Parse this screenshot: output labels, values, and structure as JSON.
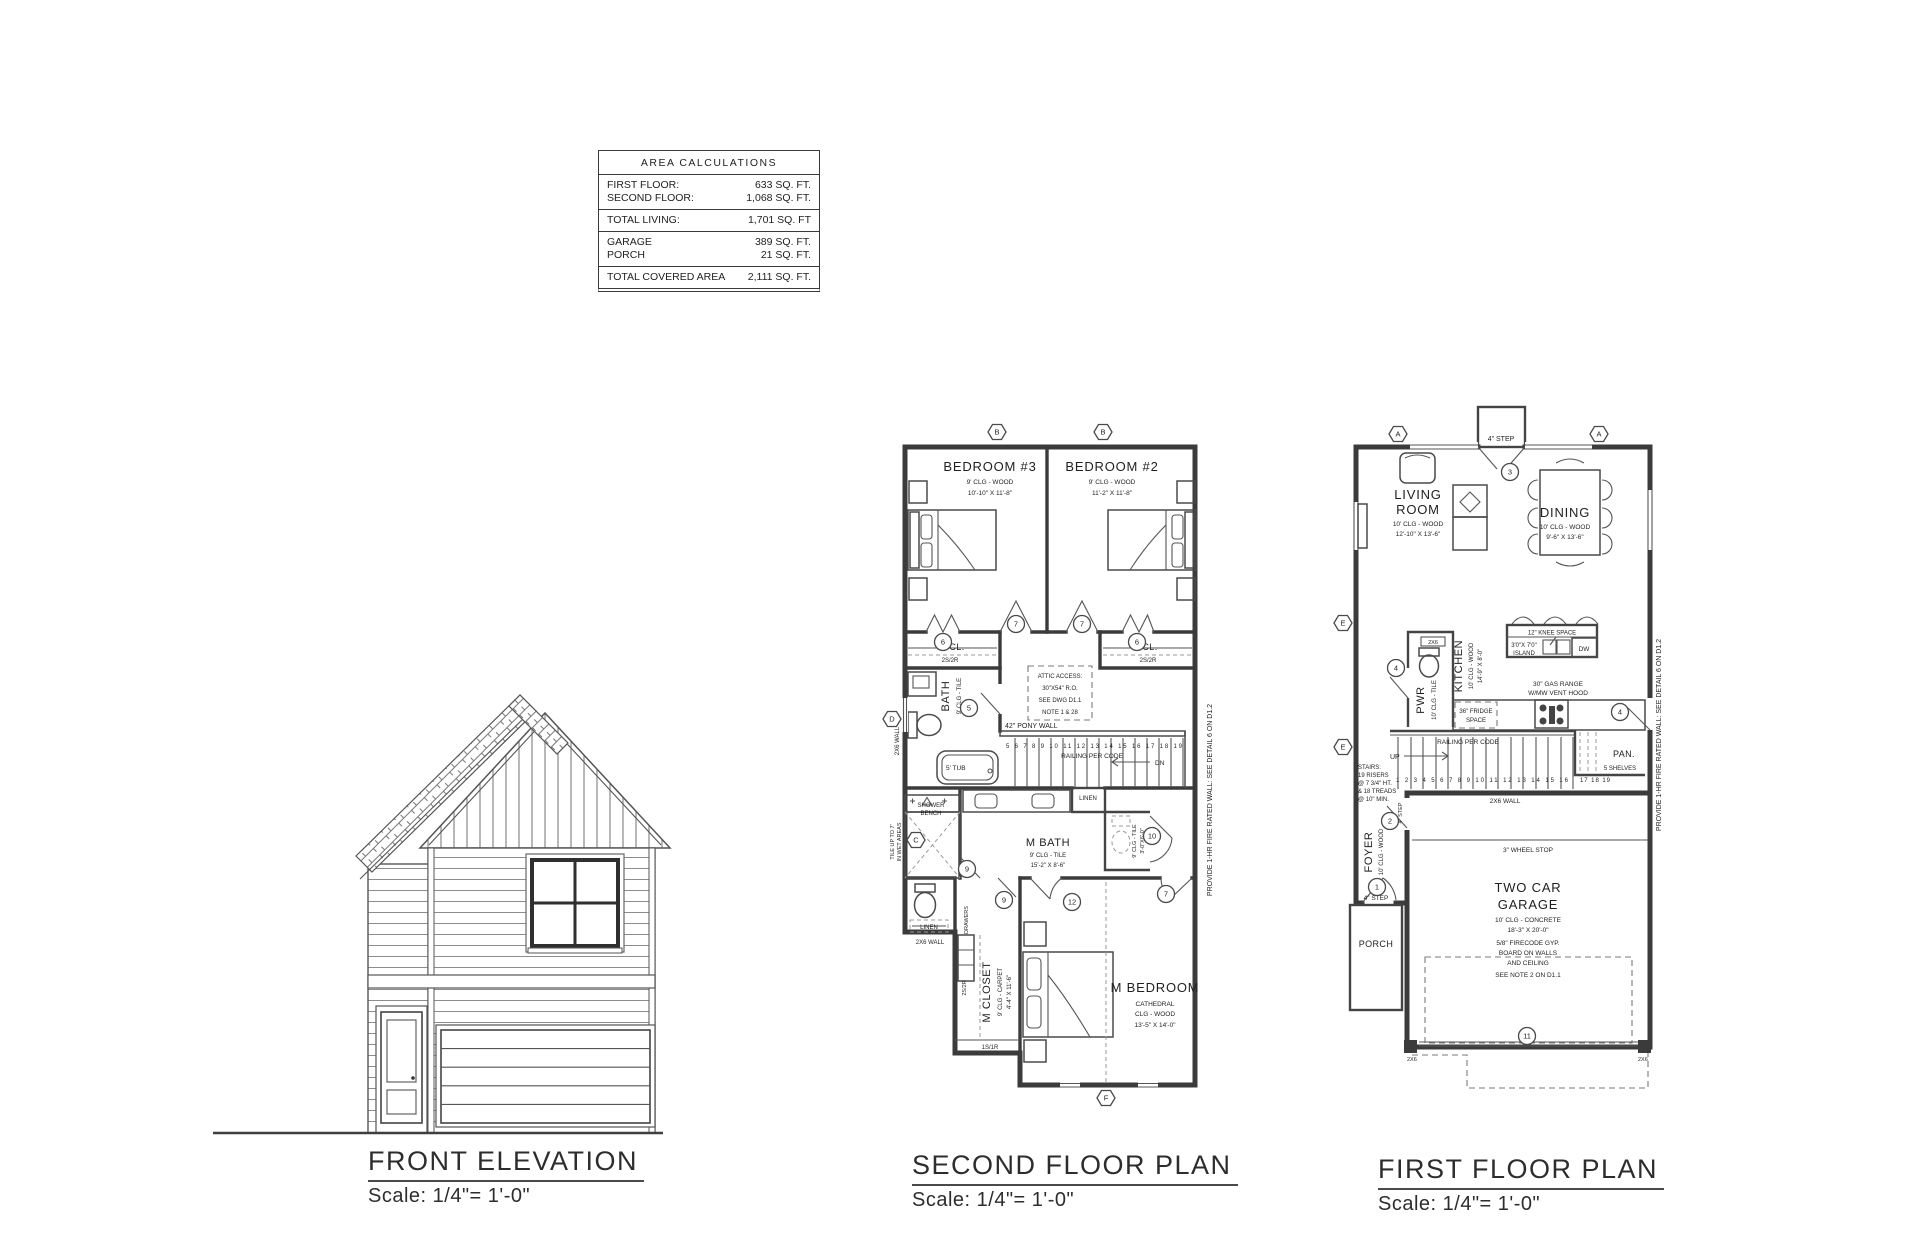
{
  "area_table": {
    "title": "AREA CALCULATIONS",
    "rows": [
      {
        "label": "FIRST FLOOR:",
        "value": "633 SQ. FT."
      },
      {
        "label": "SECOND FLOOR:",
        "value": "1,068 SQ. FT."
      },
      {
        "label": "TOTAL LIVING:",
        "value": "1,701 SQ. FT"
      },
      {
        "label": "GARAGE",
        "value": "389 SQ. FT."
      },
      {
        "label": "PORCH",
        "value": "21 SQ. FT."
      },
      {
        "label": "TOTAL COVERED AREA",
        "value": "2,111 SQ. FT."
      }
    ]
  },
  "elevation": {
    "title": "FRONT ELEVATION",
    "scale": "Scale: 1/4\"= 1'-0\""
  },
  "second_floor": {
    "title": "SECOND FLOOR PLAN",
    "scale": "Scale: 1/4\"= 1'-0\"",
    "bedroom3": [
      "BEDROOM #3",
      "9' CLG - WOOD",
      "10'-10\" X 11'-8\""
    ],
    "bedroom2": [
      "BEDROOM #2",
      "9' CLG - WOOD",
      "11'-2\" X 11'-8\""
    ],
    "closet_cl": "CL.",
    "closet_shelf": "2S/2R",
    "attic": [
      "ATTIC ACCESS:",
      "30\"X54\" R.O.",
      "SEE DWG D1.1",
      "NOTE 1 & 28"
    ],
    "bath": [
      "BATH",
      "9' CLG - TILE"
    ],
    "pony_wall": "42\" PONY WALL",
    "railing": "RAILING PER CODE",
    "dn": "DN",
    "tub": "5' TUB",
    "shower": [
      "SHOWER",
      "BENCH"
    ],
    "wet_note": [
      "TILE UP TO 7'",
      "IN WET AREAS"
    ],
    "mbath": [
      "M BATH",
      "9' CLG - TILE",
      "15'-2\" X 8'-6\""
    ],
    "linen": "LINEN",
    "wc": [
      "9' CLG - TILE",
      "3'-0\"X6'-0\""
    ],
    "mcloset": [
      "M CLOSET",
      "9' CLG - CARPET",
      "4'-4\" X 11'-6\""
    ],
    "drawers": "DRAWERS",
    "shelf_2s2r": "2S/2R",
    "shelf_1s1r": "1S/1R",
    "wall_2x6": "2X6 WALL",
    "mbedroom": [
      "M BEDROOM",
      "CATHEDRAL",
      "CLG - WOOD",
      "13'-5\" X 14'-0\""
    ],
    "stair_numbers": "5 6 7 8 9 10 11 12 13 14 15 16 17 18 19",
    "firewall": "PROVIDE 1-HR FIRE RATED WALL: SEE DETAIL 6 ON D1.2"
  },
  "first_floor": {
    "title": "FIRST FLOOR PLAN",
    "scale": "Scale: 1/4\"= 1'-0\"",
    "step_top": "4\" STEP",
    "living": [
      "LIVING",
      "ROOM",
      "10' CLG - WOOD",
      "12'-10\" X 13'-6\""
    ],
    "dining": [
      "DINING",
      "10' CLG - WOOD",
      "9'-6\" X 13'-6\""
    ],
    "kitchen": [
      "KITCHEN",
      "10' CLG - WOOD",
      "14'-9\" X 8'-0\""
    ],
    "pwr": [
      "PWR",
      "10' CLG - TILE"
    ],
    "pwr_2x6": "2X6",
    "knee_space": "12\" KNEE SPACE",
    "island": [
      "3'0\"X 7'0\"",
      "ISLAND"
    ],
    "dw": "DW",
    "range": [
      "30\" GAS RANGE",
      "W/MW VENT HOOD"
    ],
    "fridge": [
      "36\" FRIDGE",
      "SPACE"
    ],
    "railing": "RAILING PER CODE",
    "up": "UP",
    "stairs_note": [
      "STAIRS:",
      "19 RISERS",
      "@ 7 3/4\" HT.",
      "& 18 TREADS",
      "@ 10\" MIN."
    ],
    "stair_numbers": "1 2 3 4 5 6 7 8 9 10 11 12 13 14 15 16",
    "stair_numbers2": "17 18 19",
    "wall_2x6": "2X6 WALL",
    "pantry": [
      "PAN.",
      "5 SHELVES"
    ],
    "foyer": [
      "FOYER",
      "10' CLG - WOOD"
    ],
    "step_side": "4\" STEP",
    "step_front": "4\" STEP",
    "porch": "PORCH",
    "wheel_stop": "3\" WHEEL STOP",
    "garage": [
      "TWO CAR",
      "GARAGE",
      "10' CLG - CONCRETE",
      "18'-3\" X 20'-0\"",
      "5/8\" FIRECODE GYP.",
      "BOARD ON WALLS",
      "AND CEILING",
      "SEE NOTE 2 ON D1.1"
    ],
    "corner_2x6": "2X6",
    "firewall": "PROVIDE 1-HR FIRE RATED WALL: SEE DETAIL 6 ON D1.2"
  },
  "markers": {
    "a": "A",
    "b": "B",
    "c": "C",
    "d": "D",
    "e": "E",
    "f": "F",
    "n1": "1",
    "n2": "2",
    "n3": "3",
    "n4": "4",
    "n5": "5",
    "n6": "6",
    "n7": "7",
    "n9": "9",
    "n10": "10",
    "n11": "11",
    "n12": "12"
  }
}
